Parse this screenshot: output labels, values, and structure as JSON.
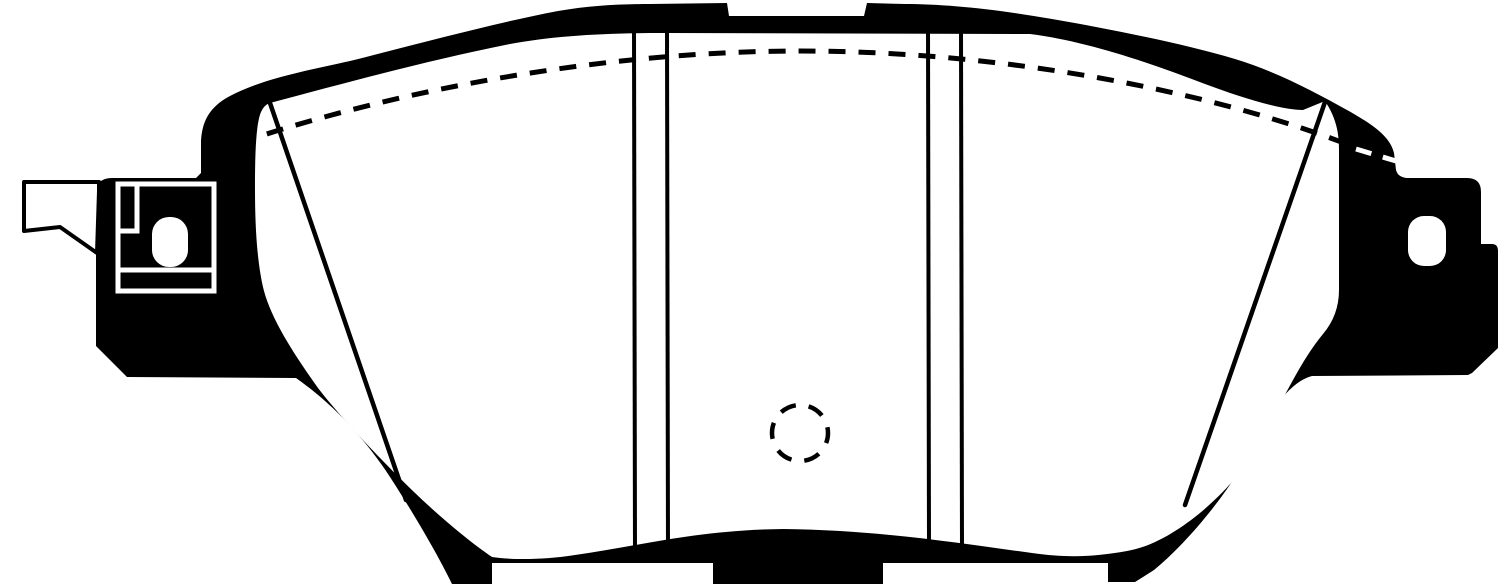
{
  "meta": {
    "description": "Technical line-art drawing of a disc brake pad with wear-indicator clip, friction-face chamfer lines, slot lines, hidden-edge dashed arc and dashed center mark",
    "canvas": {
      "width": 1500,
      "height": 584
    },
    "colors": {
      "ink": "#000000",
      "paper": "#ffffff"
    }
  },
  "drawing": {
    "shapes": [
      {
        "name": "backing-plate-silhouette",
        "tag": "path",
        "attrs": {
          "d": "M 96,194 Q 96,178 112,178 L 196,178 L 201,173 L 201,141 C 202,120 211,106 230,96 C 262,79 305,71 350,61 C 410,46 490,24 558,11 C 592,5 625,4 650,4 L 727,3 L 729,16 L 864,16 L 867,3 L 905,4 C 945,4 995,9 1052,19 C 1115,30 1185,44 1235,59 C 1275,71 1315,92 1347,110 C 1372,124 1390,136 1394,153 L 1396,170 Q 1398,178 1409,178 L 1467,178 Q 1481,178 1481,192 L 1481,244 L 1492,244 Q 1498,244 1498,251 L 1498,348 L 1472,373 L 1468,375 L 1312,376 C 1292,381 1272,406 1252,447 C 1232,490 1185,545 1154,570 L 1135,582 L 1108,582 L 1108,563 L 883,563 L 883,584 L 713,584 L 713,563 L 492,563 L 492,584 L 452,584 L 448,576 C 436,552 414,514 390,477 C 362,434 330,402 296,378 L 127,377 L 96,346 Z",
          "fill": "@ink",
          "stroke": "none"
        }
      },
      {
        "name": "friction-face",
        "tag": "path",
        "attrs": {
          "d": "M 270,103 C 345,83 430,60 505,45 C 555,35 610,33 665,33 L 1030,34 C 1085,41 1145,61 1205,84 C 1240,97 1280,110 1303,110 L 1325,101 C 1334,115 1339,128 1339,150 L 1339,290 Q 1339,315 1323,334 C 1302,359 1283,399 1261,441 C 1239,484 1177,543 1127,551 C 1093,557 1067,558 1032,553 C 965,544 880,530 783,529 C 695,530 635,547 575,555 C 543,560 512,560 492,557 C 470,542 441,518 414,492 C 383,462 341,418 318,388 C 296,357 272,321 264,291 C 257,264 255,225 255,190 C 255,152 256,124 261,112 Q 264,105 270,103 Z",
          "fill": "@paper",
          "stroke": "none"
        }
      },
      {
        "name": "right-lug-hole",
        "tag": "rect",
        "attrs": {
          "x": "1408",
          "y": "216",
          "width": "38",
          "height": "50",
          "rx": "16",
          "fill": "@paper",
          "stroke": "none"
        }
      },
      {
        "name": "hidden-edge-dashed-arc",
        "tag": "path",
        "attrs": {
          "d": "M 210,153 C 400,85 620,51 800,51 C 1000,51 1210,90 1357,148",
          "fill": "none",
          "stroke": "@ink",
          "stroke-width": "5",
          "stroke-dasharray": "17 13"
        }
      },
      {
        "name": "hidden-edge-dashes-over-body",
        "tag": "path",
        "attrs": {
          "d": "M 1356,149 L 1396,161",
          "fill": "none",
          "stroke": "@paper",
          "stroke-width": "5",
          "stroke-dasharray": "16 12"
        }
      },
      {
        "name": "left-chamfer-line",
        "tag": "path",
        "attrs": {
          "d": "M 270,103 L 406,500",
          "fill": "none",
          "stroke": "@ink",
          "stroke-width": "4.5",
          "stroke-linecap": "round"
        }
      },
      {
        "name": "right-chamfer-line",
        "tag": "path",
        "attrs": {
          "d": "M 1325,102 L 1185,505",
          "fill": "none",
          "stroke": "@ink",
          "stroke-width": "4.5",
          "stroke-linecap": "round"
        }
      },
      {
        "name": "left-slot-line-1",
        "tag": "path",
        "attrs": {
          "d": "M 634,30 L 635,558",
          "fill": "none",
          "stroke": "@ink",
          "stroke-width": "4"
        }
      },
      {
        "name": "left-slot-line-2",
        "tag": "path",
        "attrs": {
          "d": "M 667,30 L 668,558",
          "fill": "none",
          "stroke": "@ink",
          "stroke-width": "4"
        }
      },
      {
        "name": "right-slot-line-1",
        "tag": "path",
        "attrs": {
          "d": "M 928,30 L 929,550",
          "fill": "none",
          "stroke": "@ink",
          "stroke-width": "4"
        }
      },
      {
        "name": "right-slot-line-2",
        "tag": "path",
        "attrs": {
          "d": "M 961,30 L 962,553",
          "fill": "none",
          "stroke": "@ink",
          "stroke-width": "4"
        }
      },
      {
        "name": "center-mark-dashed-circle",
        "tag": "circle",
        "attrs": {
          "cx": "800",
          "cy": "433",
          "r": "28",
          "fill": "none",
          "stroke": "@ink",
          "stroke-width": "4.5",
          "stroke-dasharray": "16.3 13",
          "stroke-dashoffset": "6"
        }
      },
      {
        "name": "clip-frame-outline",
        "tag": "rect",
        "attrs": {
          "x": "118",
          "y": "184",
          "width": "96",
          "height": "107",
          "fill": "none",
          "stroke": "@paper",
          "stroke-width": "5"
        }
      },
      {
        "name": "clip-step-line",
        "tag": "path",
        "attrs": {
          "d": "M 137,184 L 137,231 L 118,231",
          "fill": "none",
          "stroke": "@paper",
          "stroke-width": "5"
        }
      },
      {
        "name": "clip-lower-line",
        "tag": "path",
        "attrs": {
          "d": "M 118,270 L 214,270",
          "fill": "none",
          "stroke": "@paper",
          "stroke-width": "5"
        }
      },
      {
        "name": "clip-slot-hole",
        "tag": "rect",
        "attrs": {
          "x": "152",
          "y": "217",
          "width": "36",
          "height": "50",
          "rx": "17",
          "fill": "@paper",
          "stroke": "none"
        }
      },
      {
        "name": "wear-sensor-tab",
        "tag": "path",
        "attrs": {
          "d": "M 24,182 L 99,182 L 99,191 L 97,253 L 60,227 L 24,231 Z",
          "fill": "@paper",
          "stroke": "@ink",
          "stroke-width": "4",
          "stroke-linejoin": "round"
        }
      }
    ]
  }
}
